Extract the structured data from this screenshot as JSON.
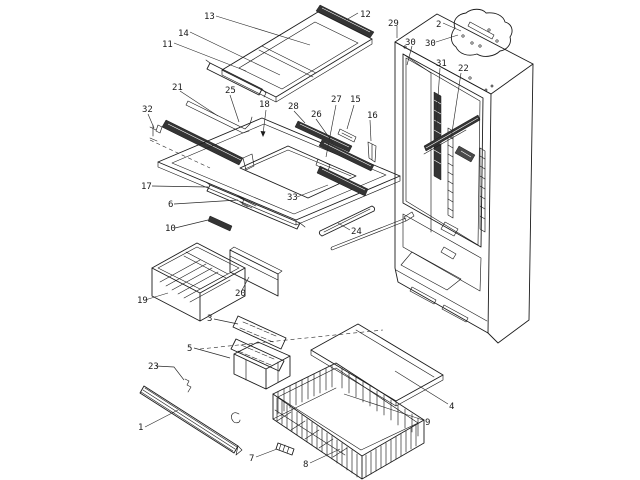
{
  "figure": {
    "kind": "exploded-parts-diagram",
    "background": "#ffffff",
    "line_color": "#1c1c1c",
    "label_color": "#1a1a1a"
  },
  "callouts": [
    {
      "label": "13"
    },
    {
      "label": "12"
    },
    {
      "label": "14"
    },
    {
      "label": "11"
    },
    {
      "label": "29"
    },
    {
      "label": "2"
    },
    {
      "label": "30"
    },
    {
      "label": "30"
    },
    {
      "label": "21"
    },
    {
      "label": "25"
    },
    {
      "label": "32"
    },
    {
      "label": "18"
    },
    {
      "label": "28"
    },
    {
      "label": "26"
    },
    {
      "label": "27"
    },
    {
      "label": "15"
    },
    {
      "label": "16"
    },
    {
      "label": "31"
    },
    {
      "label": "22"
    },
    {
      "label": "17"
    },
    {
      "label": "33"
    },
    {
      "label": "6"
    },
    {
      "label": "10"
    },
    {
      "label": "24"
    },
    {
      "label": "19"
    },
    {
      "label": "20"
    },
    {
      "label": "3"
    },
    {
      "label": "5"
    },
    {
      "label": "23"
    },
    {
      "label": "1"
    },
    {
      "label": "7"
    },
    {
      "label": "8"
    },
    {
      "label": "4"
    },
    {
      "label": "9"
    }
  ]
}
